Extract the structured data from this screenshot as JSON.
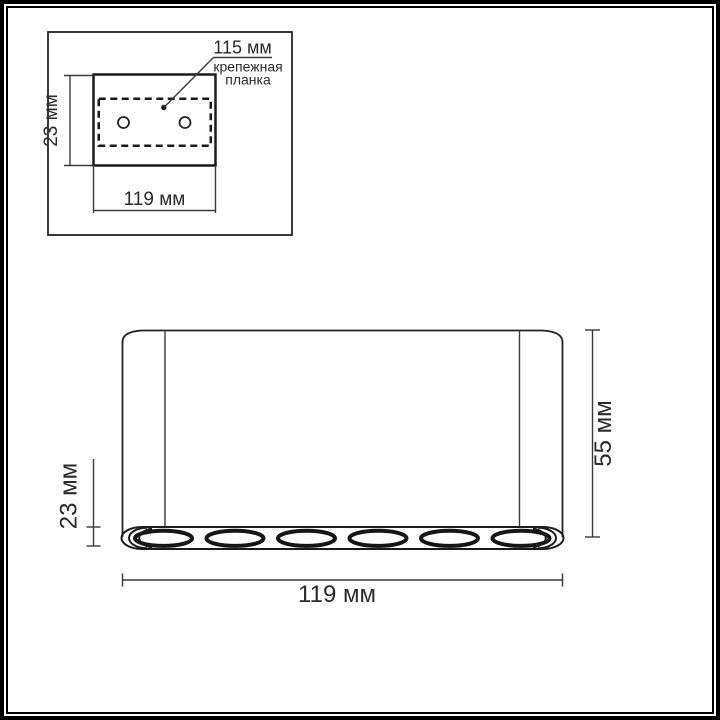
{
  "title": "Luminaire dimension drawing",
  "inset": {
    "plate_dimension": "115 мм",
    "plate_label_line1": "крепежная",
    "plate_label_line2": "планка",
    "depth_dimension": "23 мм",
    "width_dimension": "119 мм"
  },
  "front_view": {
    "height_dimension": "55 мм",
    "lens_section_dimension": "23 мм",
    "width_dimension": "119 мм",
    "lens_count": 6
  },
  "colors": {
    "line": "#242424",
    "background": "#ffffff"
  }
}
